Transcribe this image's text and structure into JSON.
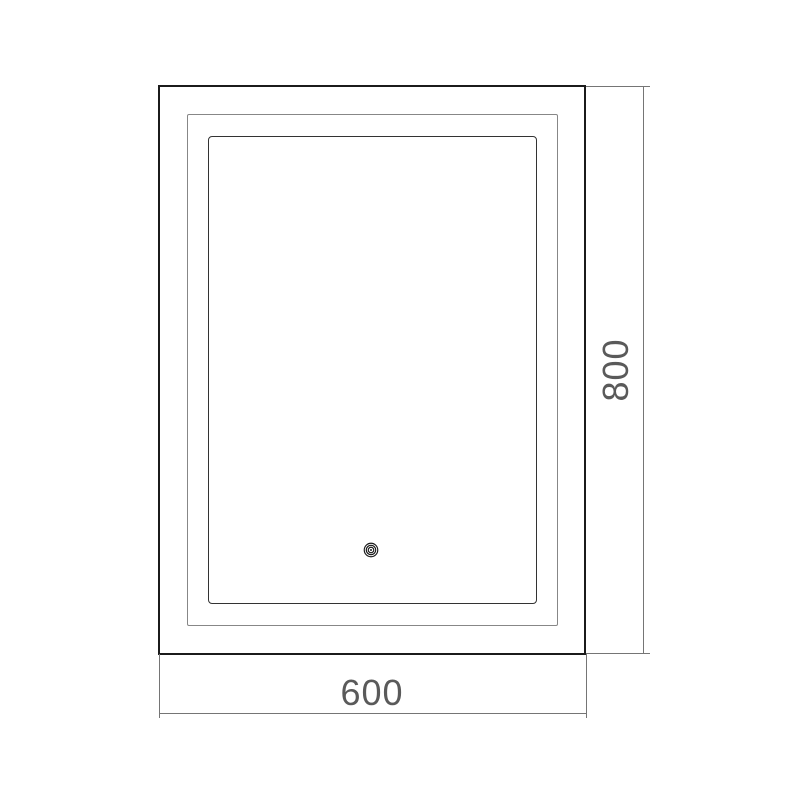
{
  "drawing": {
    "dimensions": {
      "width_label": "600",
      "height_label": "800"
    },
    "icons": {
      "touch_sensor": "concentric-rings-touch-button"
    },
    "colors": {
      "background": "#ffffff",
      "outer_line": "#1b1b1b",
      "middle_line": "#878787",
      "inner_line": "#333333",
      "dimension_line": "#757575",
      "dimension_text": "#5a5a5a"
    }
  }
}
